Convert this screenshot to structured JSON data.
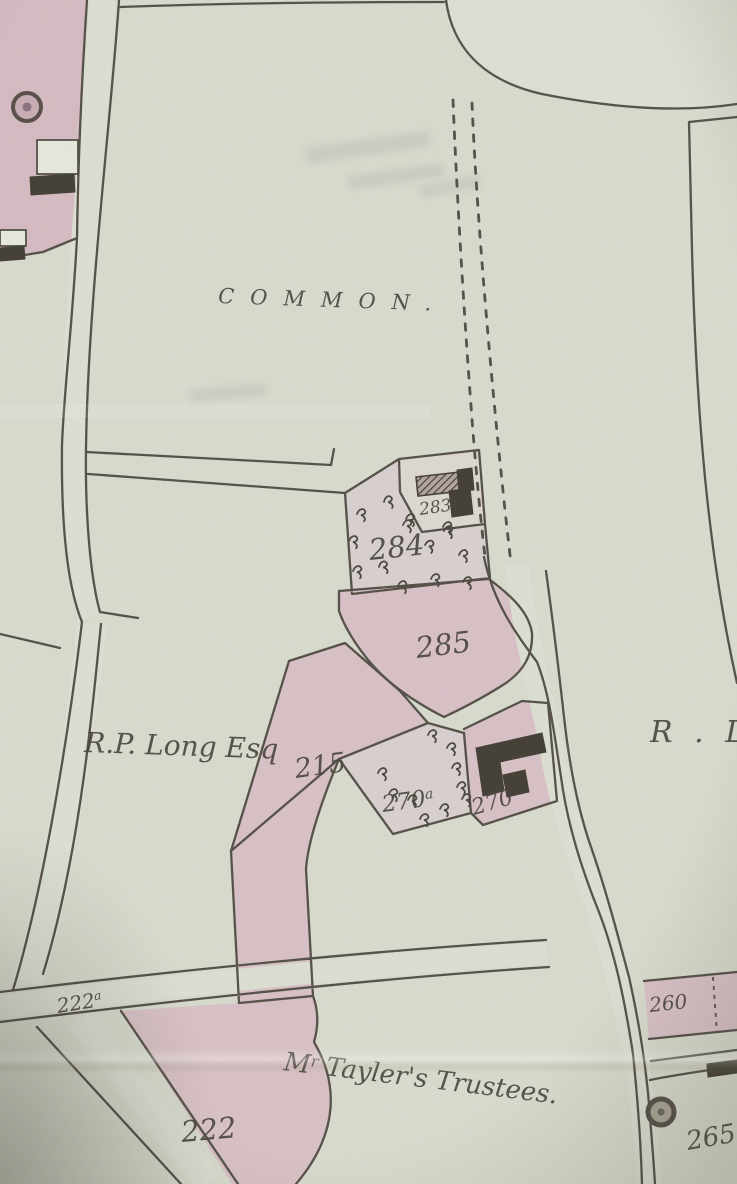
{
  "map": {
    "kind": "photograph of a historic estate map",
    "colors": {
      "paper": "#d8dbce",
      "paper_light": "#dde0d4",
      "road": "#dcdfd3",
      "pink": "#d9c2c7",
      "pink_deep": "#d5bcc3",
      "pink_pale": "#d8d1d0",
      "pink_pale2": "#ded8d3",
      "ink": "#56524a",
      "ink_dots": "#4d4941",
      "text_ink": "#4b473f",
      "building": "#454138"
    },
    "labels": [
      {
        "id": "common",
        "text": "COMMON.",
        "x": 218,
        "y": 303,
        "size": 21,
        "rotate": 2,
        "spacing": 16
      },
      {
        "id": "owner-rp-long-esq",
        "text": "R.P. Long Esq",
        "x": 84,
        "y": 752,
        "size": 28,
        "rotate": 2
      },
      {
        "id": "owner-right-partial",
        "text": "R . L",
        "x": 650,
        "y": 742,
        "size": 30,
        "rotate": 0,
        "spacing": 6
      },
      {
        "id": "owner-taylers-trustees",
        "text": "M^r Tayler's Trustees.",
        "x": 283,
        "y": 1070,
        "size": 26,
        "rotate": 7
      },
      {
        "id": "parcel-283",
        "text": "283",
        "x": 420,
        "y": 515,
        "size": 17,
        "rotate": -8
      },
      {
        "id": "parcel-284",
        "text": "284",
        "x": 370,
        "y": 560,
        "size": 29,
        "rotate": -6
      },
      {
        "id": "parcel-285",
        "text": "285",
        "x": 417,
        "y": 658,
        "size": 29,
        "rotate": -7
      },
      {
        "id": "parcel-215",
        "text": "215",
        "x": 296,
        "y": 778,
        "size": 27,
        "rotate": -8
      },
      {
        "id": "parcel-270a",
        "text": "270^a",
        "x": 383,
        "y": 812,
        "size": 23,
        "rotate": -8
      },
      {
        "id": "parcel-270",
        "text": "270",
        "x": 474,
        "y": 815,
        "size": 22,
        "rotate": -16
      },
      {
        "id": "parcel-222a",
        "text": "222^a",
        "x": 58,
        "y": 1013,
        "size": 20,
        "rotate": -9
      },
      {
        "id": "parcel-222",
        "text": "222",
        "x": 182,
        "y": 1142,
        "size": 29,
        "rotate": -5
      },
      {
        "id": "parcel-260",
        "text": "260",
        "x": 650,
        "y": 1012,
        "size": 20,
        "rotate": -6
      },
      {
        "id": "parcel-265",
        "text": "265",
        "x": 688,
        "y": 1150,
        "size": 26,
        "rotate": -10
      }
    ]
  }
}
